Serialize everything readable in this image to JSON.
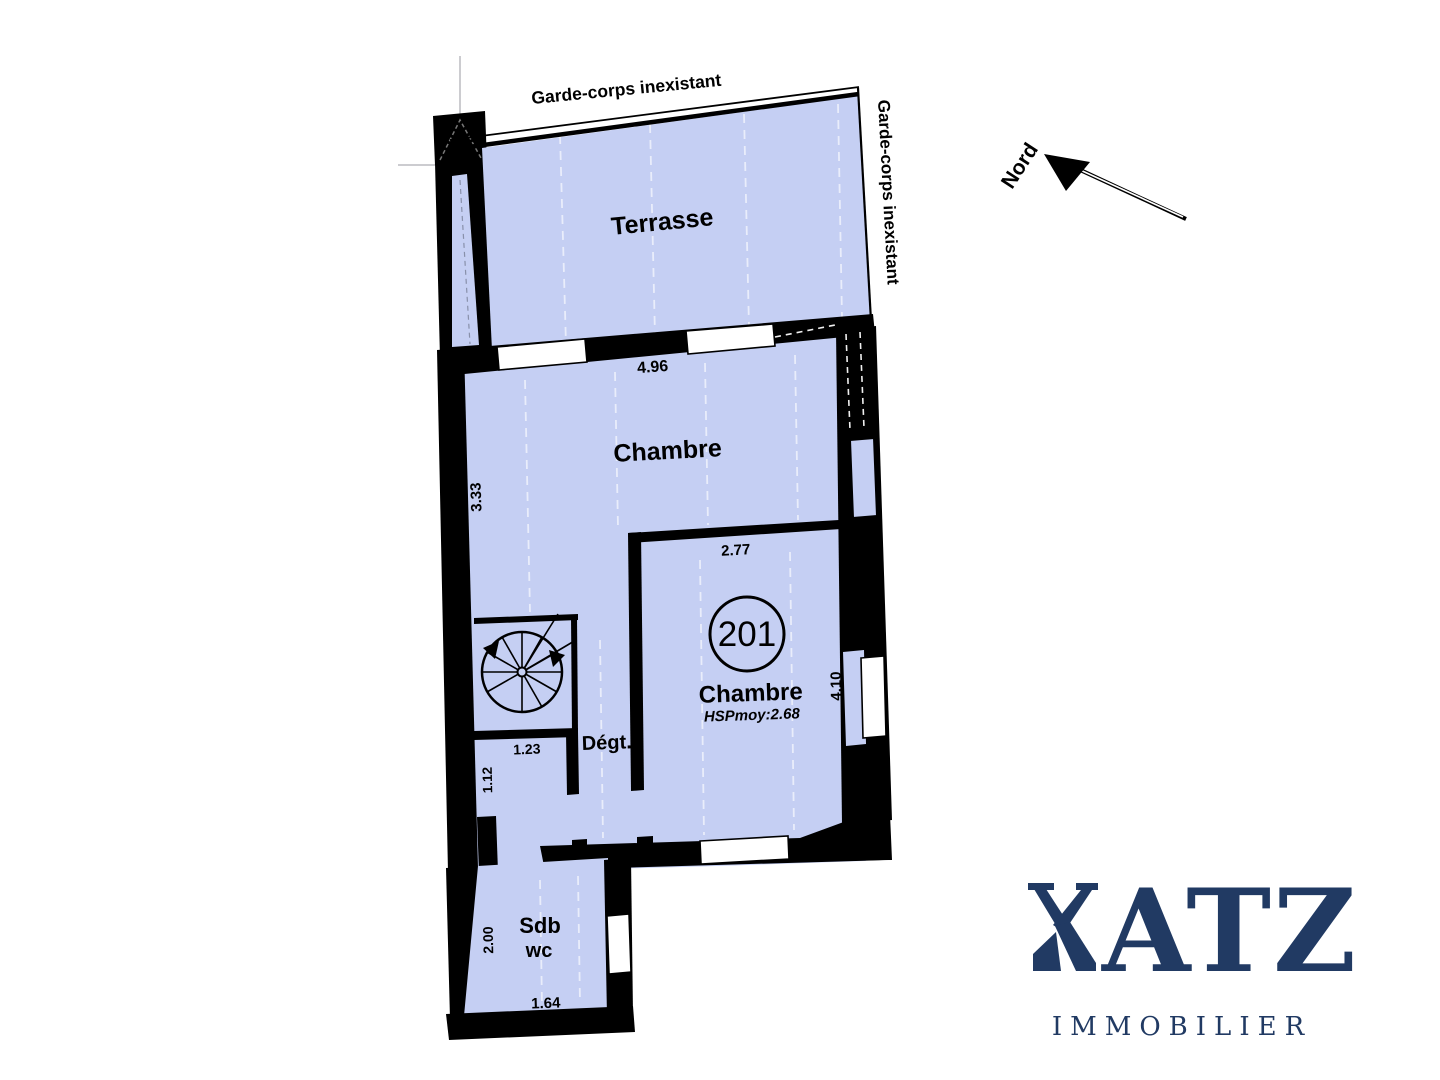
{
  "plan": {
    "north_label": "Nord",
    "notes": {
      "garde_top": "Garde-corps inexistant",
      "garde_right": "Garde-corps inexistant"
    },
    "rooms": {
      "terrasse": "Terrasse",
      "chambre1": "Chambre",
      "number": "201",
      "chambre2": "Chambre",
      "hsp": "HSPmoy:2.68",
      "degt": "Dégt.",
      "sdb": "Sdb",
      "wc": "wc"
    },
    "dims": {
      "d496": "4.96",
      "d333": "3.33",
      "d277": "2.77",
      "d410": "4.10",
      "d123": "1.23",
      "d112": "1.12",
      "d200": "2.00",
      "d164": "1.64"
    },
    "colors": {
      "room_fill": "#c5cff3",
      "wall": "#000000",
      "logo_navy": "#213a63"
    }
  },
  "logo": {
    "name": "KATZ",
    "name_rest": "ATZ",
    "tagline": "IMMOBILIER"
  }
}
